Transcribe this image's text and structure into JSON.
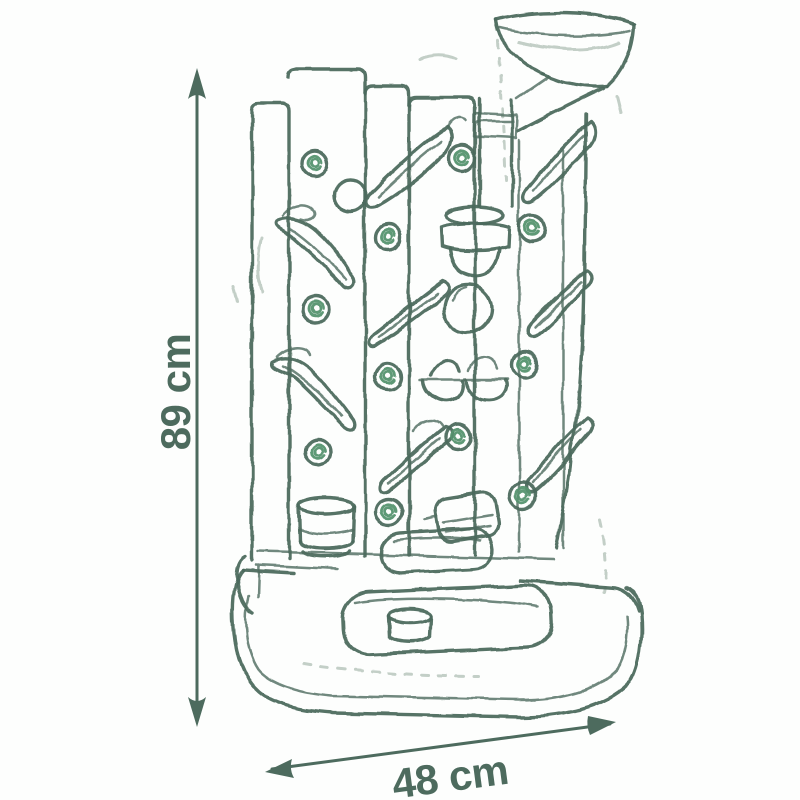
{
  "page": {
    "kind": "product dimension sketch diagram"
  },
  "dimensions": {
    "height": {
      "label": "89 cm",
      "value": 89,
      "unit": "cm",
      "orientation": "vertical"
    },
    "width": {
      "label": "48 cm",
      "value": 48,
      "unit": "cm",
      "orientation": "horizontal"
    }
  },
  "colors": {
    "ink": "#4d6b5e",
    "peg_accent": "#55936f",
    "faint": "#c3cfc7",
    "background": "#fdfefd"
  },
  "sketch": {
    "subject": "marble-run activity wall toy",
    "parts": [
      "funnel",
      "down-pipe",
      "planks",
      "chutes",
      "pegs",
      "cup",
      "scoop-pair",
      "ball",
      "roller-block",
      "tray",
      "basin",
      "cylinder"
    ]
  }
}
